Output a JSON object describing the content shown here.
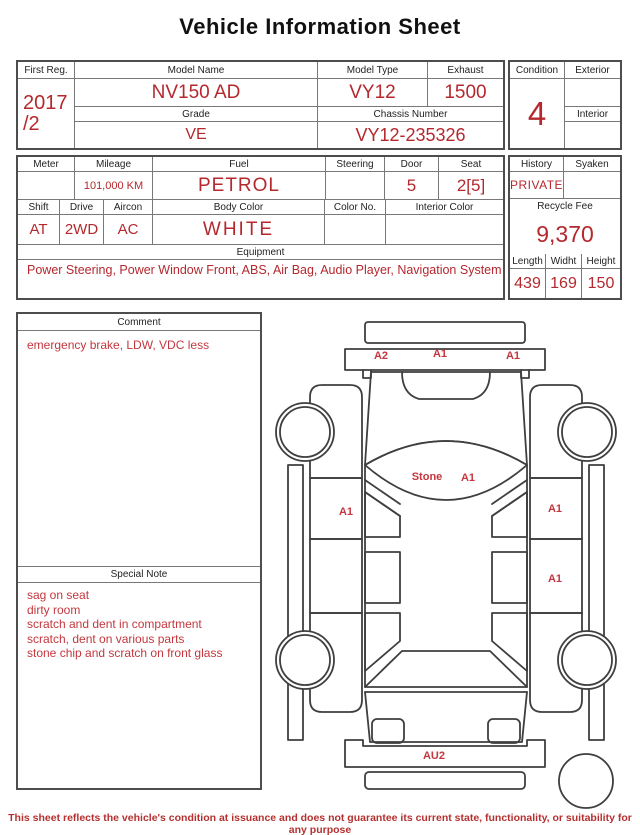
{
  "title": "Vehicle Information Sheet",
  "colors": {
    "value_red": "#b4282e",
    "label_red": "#c4373e",
    "border": "#4d4d4d"
  },
  "registration": {
    "first_reg_label": "First Reg.",
    "first_reg_year": "2017",
    "first_reg_month": "/2",
    "model_name_label": "Model Name",
    "model_name_value": "NV150 AD",
    "model_type_label": "Model Type",
    "model_type_value": "VY12",
    "exhaust_label": "Exhaust",
    "exhaust_value": "1500",
    "grade_label": "Grade",
    "grade_value": "VE",
    "chassis_label": "Chassis Number",
    "chassis_value": "VY12-235326",
    "condition_label": "Condition",
    "condition_value": "4",
    "exterior_label": "Exterior",
    "exterior_value": "",
    "interior_label": "Interior",
    "interior_value": ""
  },
  "specs": {
    "meter_label": "Meter",
    "meter_value": "",
    "mileage_label": "Mileage",
    "mileage_value": "101,000 KM",
    "fuel_label": "Fuel",
    "fuel_value": "PETROL",
    "steering_label": "Steering",
    "steering_value": "",
    "door_label": "Door",
    "door_value": "5",
    "seat_label": "Seat",
    "seat_value": "2[5]",
    "shift_label": "Shift",
    "shift_value": "AT",
    "drive_label": "Drive",
    "drive_value": "2WD",
    "aircon_label": "Aircon",
    "aircon_value": "AC",
    "body_color_label": "Body Color",
    "body_color_value": "WHITE",
    "color_no_label": "Color No.",
    "color_no_value": "",
    "interior_color_label": "Interior Color",
    "interior_color_value": "",
    "equipment_label": "Equipment",
    "equipment_value": "Power Steering, Power Window  Front, ABS, Air Bag, Audio Player, Navigation System",
    "history_label": "History",
    "history_value": "PRIVATE",
    "syaken_label": "Syaken",
    "syaken_value": "",
    "recycle_label": "Recycle Fee",
    "recycle_value": "9,370",
    "length_label": "Length",
    "length_value": "439",
    "width_label": "Widht",
    "width_value": "169",
    "height_label": "Height",
    "height_value": "150"
  },
  "comment": {
    "label": "Comment",
    "text": "emergency brake, LDW, VDC less"
  },
  "special_note": {
    "label": "Special Note",
    "lines": [
      "sag on seat",
      "dirty room",
      "scratch and dent in compartment",
      "scratch, dent on various parts",
      "stone chip and scratch on front glass"
    ]
  },
  "diagram": {
    "labels": [
      "A2",
      "A1",
      "A1",
      "Stone",
      "A1",
      "A1",
      "A1",
      "A1",
      "AU2"
    ]
  },
  "footer": "This sheet reflects the vehicle's condition at issuance and does not guarantee its current state, functionality, or suitability for any purpose"
}
